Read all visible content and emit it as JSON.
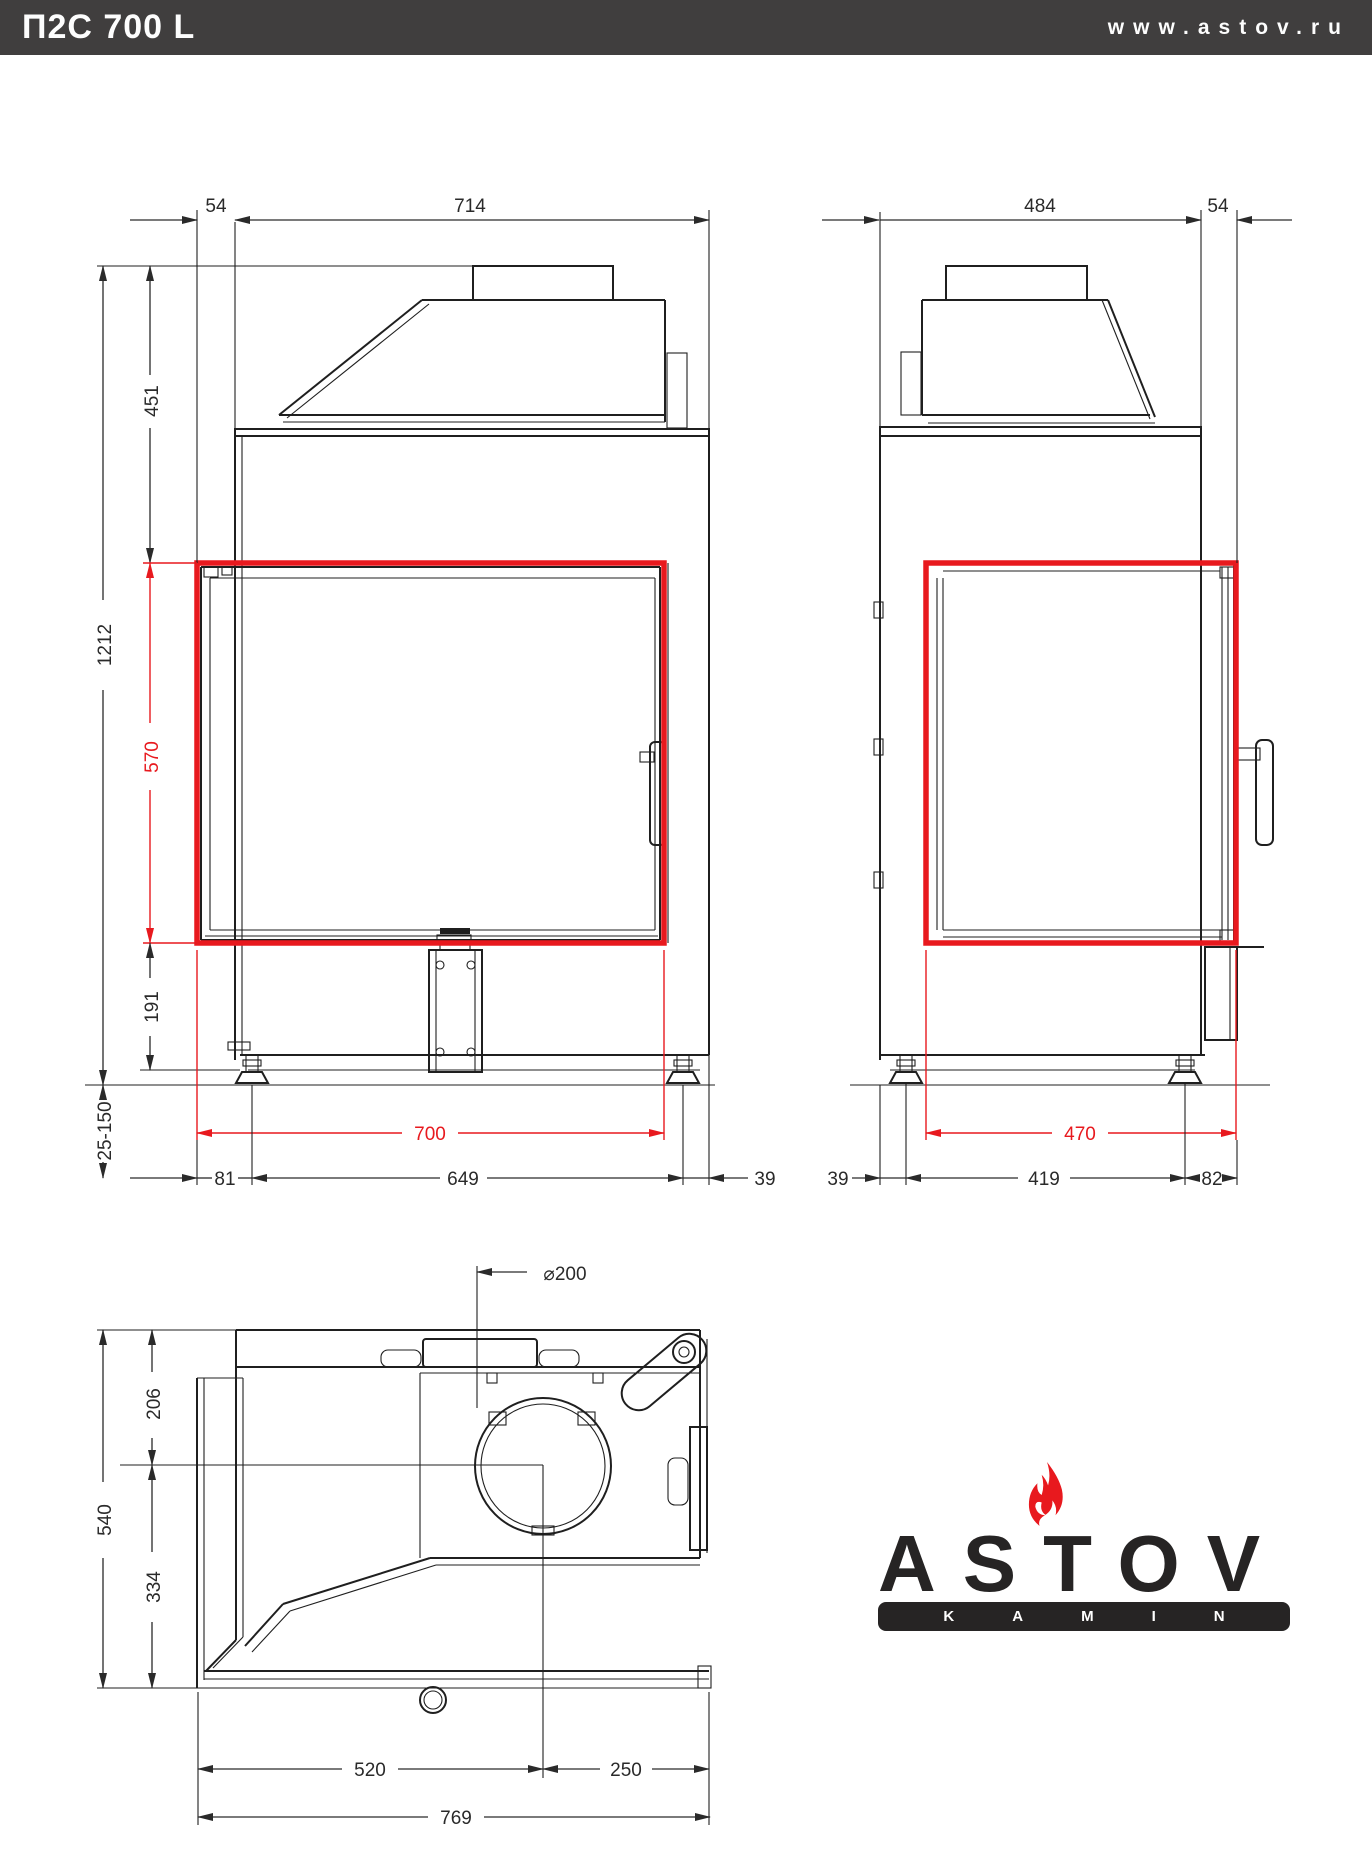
{
  "header": {
    "title": "П2С 700 L",
    "website": "www.astov.ru"
  },
  "colors": {
    "header_bg": "#403e3e",
    "line": "#1f1f1f",
    "accent_red": "#e8191e",
    "logo_dark": "#262424"
  },
  "dims": {
    "front": {
      "offset_top": "54",
      "width_top": "714",
      "hood_height": "451",
      "total_height": "1212",
      "glass_height": "570",
      "base_height": "191",
      "leg_range": "25-150",
      "glass_width": "700",
      "left_offset": "81",
      "leg_span": "649",
      "right_offset": "39"
    },
    "side": {
      "depth": "484",
      "front_offset": "54",
      "glass_depth": "470",
      "back_offset": "39",
      "leg_span": "419",
      "front_leg_offset": "82"
    },
    "top": {
      "flue_diameter": "⌀200",
      "flue_back_offset": "206",
      "total_depth": "540",
      "flue_front_offset": "334",
      "flue_left_offset": "520",
      "flue_right_offset": "250",
      "total_width": "769"
    }
  },
  "logo": {
    "brand": "ASTOV",
    "tagline": "KAMIN"
  }
}
